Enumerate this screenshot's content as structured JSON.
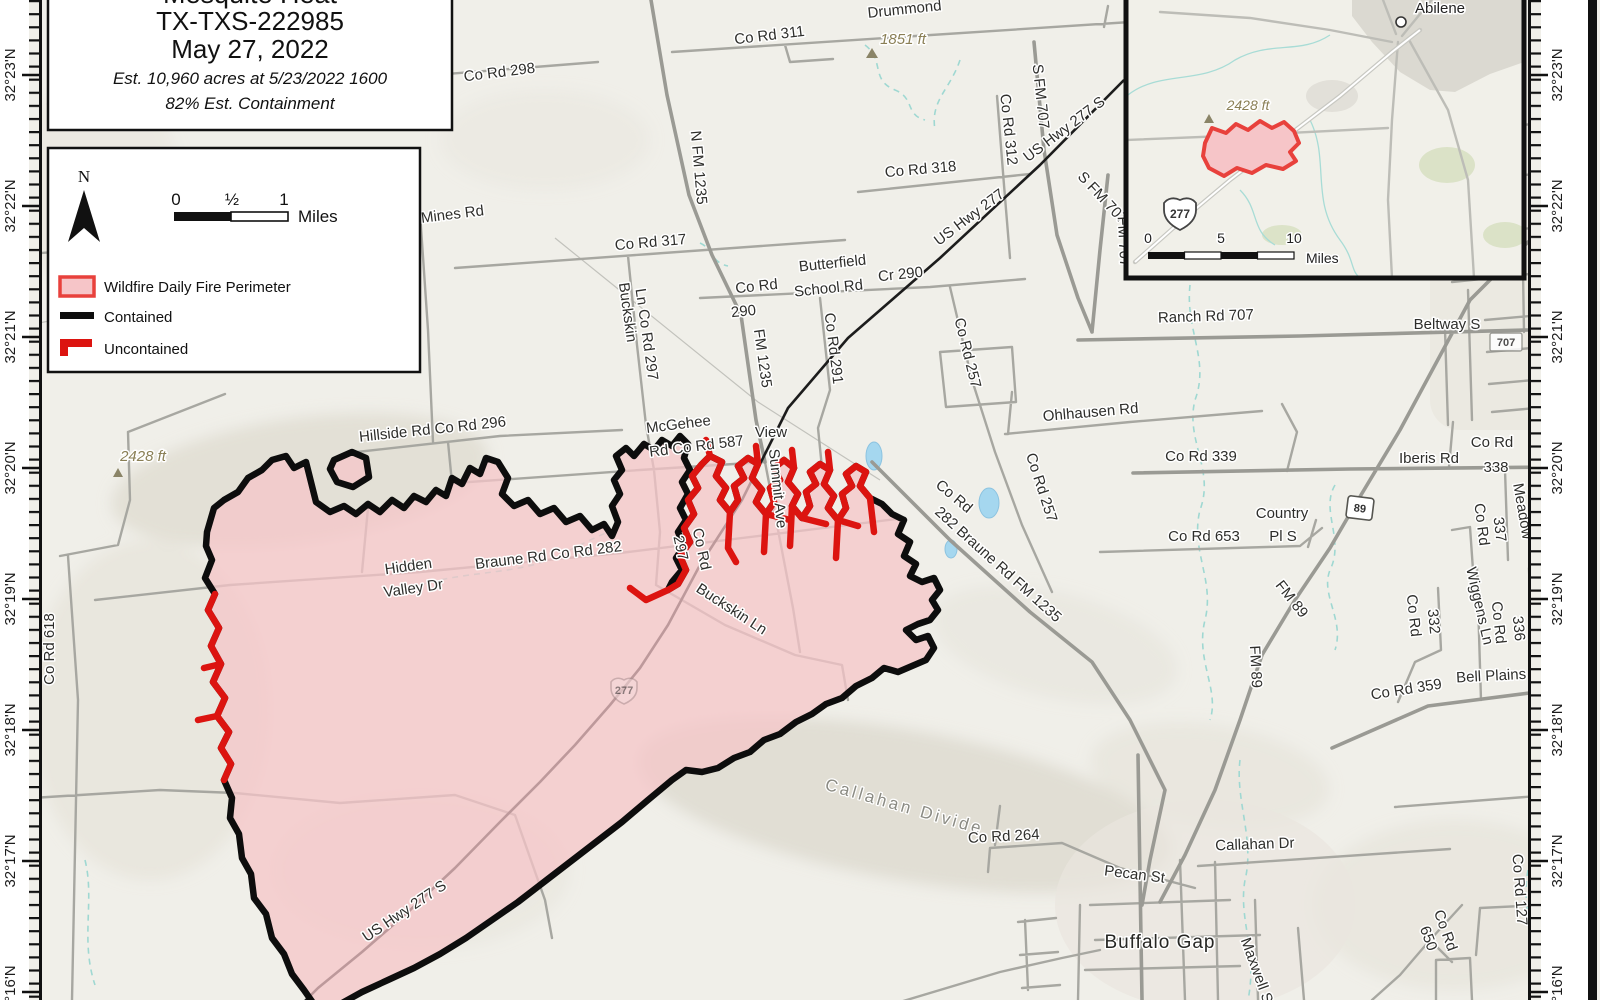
{
  "title_box": {
    "name": "Mesquite Heat",
    "incident": "TX-TXS-222985",
    "date": "May 27, 2022",
    "estimate": "Est. 10,960 acres at 5/23/2022 1600",
    "containment": "82% Est. Containment"
  },
  "legend": {
    "north": "N",
    "scale_0": "0",
    "scale_half": "½",
    "scale_1": "1",
    "scale_unit": "Miles",
    "perimeter": "Wildfire Daily Fire Perimeter",
    "contained": "Contained",
    "uncontained": "Uncontained"
  },
  "inset": {
    "city": "Abilene",
    "elevation": "2428 ft",
    "shield": "277",
    "scale_0": "0",
    "scale_5": "5",
    "scale_10": "10",
    "scale_unit": "Miles"
  },
  "graticule": {
    "left": [
      "32°23'N",
      "32°22'N",
      "32°21'N",
      "32°20'N",
      "32°19'N",
      "32°18'N",
      "32°17'N",
      "32°16'N"
    ],
    "right": [
      "32°23'N",
      "32°22'N",
      "32°21'N",
      "32°20'N",
      "32°19'N",
      "32°18'N",
      "32°17'N",
      "32°16'N"
    ]
  },
  "shields": {
    "us_277": "277",
    "tx_89": "89",
    "fm_707_small": "707",
    "us_277_pink": "277"
  },
  "colors": {
    "fire_fill": "#f6c5c8",
    "contained": "#0d0d0d",
    "uncontained": "#dc1410",
    "stream": "#9fd8d2"
  },
  "labels": {
    "drummond": "Drummond",
    "co_rd_311": "Co Rd 311",
    "elev_1851": "1851 ft",
    "co_rd_298": "Co Rd 298",
    "n_fm_1235": "N FM 1235",
    "mines_rd": "Mines Rd",
    "co_rd_317": "Co Rd 317",
    "co_rd_318": "Co Rd 318",
    "co_rd_312": "Co Rd 312",
    "s_fm_707_a": "S FM 707",
    "us277s_a": "US Hwy 277 S",
    "us277": "US Hwy 277",
    "s_fm_707_b": "S FM 707",
    "fm_707": "FM 707",
    "butterfield1": "Butterfield",
    "butterfield2": "School Rd",
    "cr_290": "Cr 290",
    "co_rd_290a": "Co Rd",
    "co_rd_290b": "290",
    "fm_1235": "FM 1235",
    "co_rd_291": "Co Rd 291",
    "co_rd_257a": "Co Rd 257",
    "ranch_rd_707": "Ranch Rd 707",
    "beltway_s": "Beltway S",
    "ohlhausen": "Ohlhausen Rd",
    "co_rd_339": "Co Rd 339",
    "iberis": "Iberis Rd",
    "co_rd_338a": "Co Rd",
    "co_rd_338b": "338",
    "kincaid": "Kincaid",
    "meadow": "Meadow",
    "co_rd_337a": "Co Rd",
    "co_rd_337b": "337",
    "country1": "Country",
    "country2": "Pl S",
    "co_rd_653": "Co Rd 653",
    "co_rd_257b": "Co Rd 257",
    "braune_diag1": "Co Rd",
    "braune_diag2": "282 Braune Rd  FM 1235",
    "mcgehee1": "McGehee",
    "mcgehee2": "Rd  Co Rd 587",
    "view": "View",
    "summit": "Summit Ave",
    "co_rd_297a": "Co Rd",
    "co_rd_297b": "297",
    "braune282": "Braune Rd  Co Rd 282",
    "hidden1": "Hidden",
    "hidden2": "Valley Dr",
    "hillside": "Hillside Rd  Co Rd 296",
    "buckskin_a1": "Buckskin",
    "buckskin_a2": "Ln  Co Rd 297",
    "buckskin_b": "Buckskin Ln",
    "elev_2428": "2428 ft",
    "co_rd_618": "Co Rd 618",
    "us277s_b": "US Hwy 277 S",
    "callahan_divide": "Callahan Divide",
    "co_rd_264": "Co Rd 264",
    "pecan": "Pecan St",
    "callahan_dr": "Callahan Dr",
    "buffalo_gap": "Buffalo Gap",
    "maxwell": "Maxwell St",
    "co_rd_650a": "Co Rd",
    "co_rd_650b": "650",
    "co_rd_127": "Co Rd 127",
    "bell_plains": "Bell Plains Rd",
    "co_rd_359": "Co Rd 359",
    "co_rd_332a": "Co Rd",
    "co_rd_332b": "332",
    "wiggens": "Wiggens Ln",
    "co_rd_336a": "Co Rd",
    "co_rd_336b": "336",
    "fm_89a": "FM 89",
    "fm_89b": "FM 89"
  }
}
